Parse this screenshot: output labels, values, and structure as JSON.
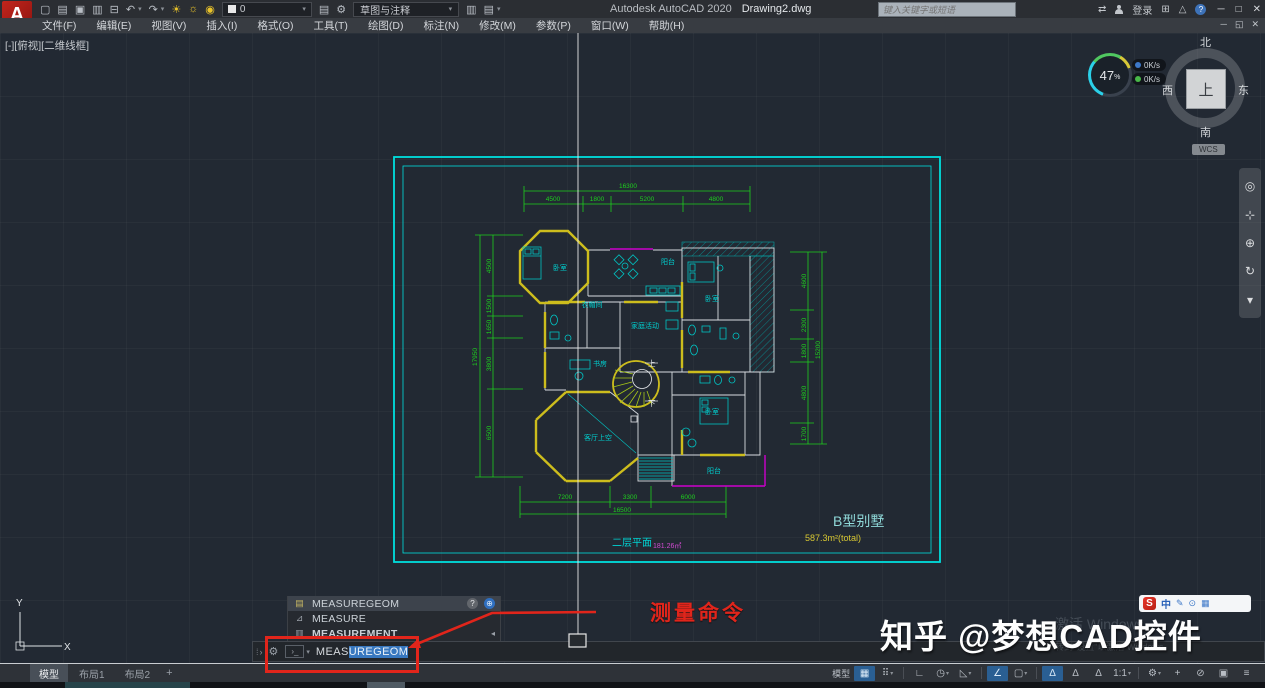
{
  "titlebar": {
    "app_title": "Autodesk AutoCAD 2020",
    "doc_title": "Drawing2.dwg",
    "search_placeholder": "键入关键字或短语",
    "signin_label": "登录",
    "layer_value": "0",
    "workspace_value": "草图与注释"
  },
  "menubar": {
    "items": [
      "文件(F)",
      "编辑(E)",
      "视图(V)",
      "插入(I)",
      "格式(O)",
      "工具(T)",
      "绘图(D)",
      "标注(N)",
      "修改(M)",
      "参数(P)",
      "窗口(W)",
      "帮助(H)"
    ]
  },
  "viewport": {
    "controls_label": "[-][俯视][二维线框]",
    "viewcube": {
      "north": "北",
      "south": "南",
      "west": "西",
      "east": "东",
      "top": "上",
      "wcs_label": "WCS"
    },
    "gauge": {
      "percent": "47",
      "percent_sign": "%",
      "up_speed": "0K/s",
      "down_speed": "0K/s"
    },
    "ucs": {
      "x_label": "X",
      "y_label": "Y"
    }
  },
  "floorplan": {
    "rooms": {
      "bedroom_tl": "卧室",
      "closet": "衣帽间",
      "terrace_top": "阳台",
      "bedroom_tr": "卧室",
      "family_room": "家庭活动",
      "study": "书房",
      "stair_up": "上",
      "stair_down": "下",
      "bedroom_br": "卧室",
      "living_void": "客厅上空",
      "balcony_br": "阳台"
    },
    "dims": {
      "top_total": "16300",
      "top": [
        "4500",
        "1800",
        "5200",
        "4800"
      ],
      "left_total": "17950",
      "left": [
        "4500",
        "1500",
        "1650",
        "3800",
        "6500"
      ],
      "right_total": "15200",
      "right": [
        "4600",
        "2300",
        "1800",
        "4800",
        "1700"
      ],
      "bottom_total": "16500",
      "bottom": [
        "7200",
        "3300",
        "6000"
      ]
    },
    "floor_title": "二层平面",
    "floor_area": "181.26㎡",
    "villa_type": "B型别墅",
    "villa_area": "587.3m²(total)"
  },
  "command": {
    "suggestions": [
      {
        "label": "MEASUREGEOM"
      },
      {
        "label": "MEASURE"
      },
      {
        "label": "MEASUREMENT"
      }
    ],
    "typed": "MEAS",
    "completion": "UREGEOM",
    "annotation_label": "测量命令"
  },
  "statusbar": {
    "tabs": [
      "模型",
      "布局1",
      "布局2"
    ],
    "add_tab": "+",
    "model_toggle": "模型",
    "scale_value": "1:1"
  },
  "overlay": {
    "watermark": "知乎 @梦想CAD控件",
    "activate_line1": "激活 Windows",
    "activate_line2": "转到\"设置\"以激活 Windows。",
    "ime_lang": "中"
  },
  "icons": {
    "qat": {
      "new": "▢",
      "open": "▤",
      "save": "▣",
      "saveas": "▥",
      "plot": "⊟",
      "undo": "↶",
      "redo": "↷",
      "bulb": "☀",
      "sun": "☼",
      "lock": "◉",
      "sheet1": "▤",
      "sheet2": "▥",
      "gear": "⚙",
      "caret": "▾"
    },
    "titlebar": {
      "exchange": "⇄",
      "cart": "⊞",
      "adrop": "△",
      "min": "─",
      "max": "□",
      "close": "✕",
      "restore": "◱"
    },
    "nav": {
      "wheel": "◎",
      "pan": "⊹",
      "zoom": "⊕",
      "orbit": "↻",
      "more": "▾"
    },
    "ime": {
      "pen": "✎",
      "mic": "⊙",
      "kbd": "▦"
    },
    "status": {
      "grid": "▦",
      "snap": "⠿",
      "ortho": "∟",
      "polar": "◷",
      "iso": "◺",
      "otrack": "∠",
      "osnap": "▢",
      "ann": "∆",
      "gear": "⚙",
      "plus": "+",
      "isolate": "⊘",
      "clean": "▣",
      "menu": "≡",
      "caret": "▾"
    },
    "cmd": {
      "grip": "⁞",
      "expand": "›",
      "wrench": "⚙",
      "prompt": "›_",
      "caret": "▾",
      "ruler": "▤",
      "measure": "⊿",
      "sheet": "▥",
      "help": "?",
      "globe": "⊕",
      "subarrow": "◂"
    }
  },
  "colors": {
    "accent_red": "#e1251b",
    "cad_green": "#1ecf1e",
    "cad_cyan": "#00d0d0",
    "cad_yellow": "#cdbd1d",
    "cad_magenta": "#cc00cc"
  }
}
